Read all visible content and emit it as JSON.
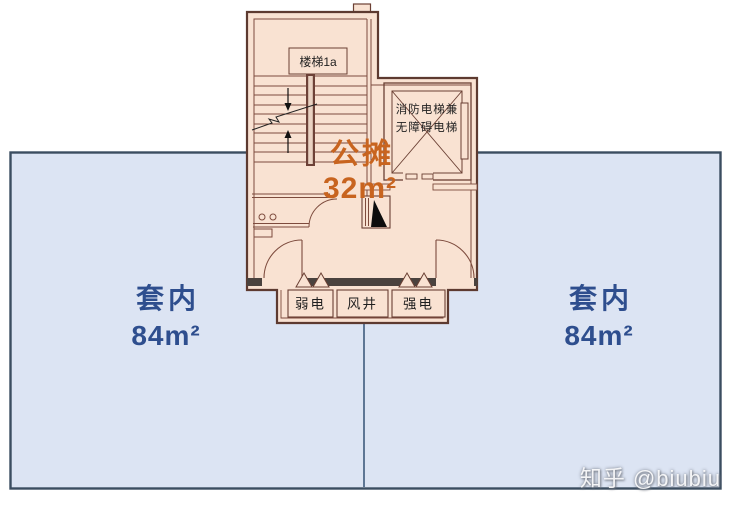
{
  "plan": {
    "stair_label": "楼梯1a",
    "elevator_label_line1": "消防电梯兼",
    "elevator_label_line2": "无障碍电梯",
    "shared": {
      "label": "公摊",
      "area": "32m²"
    },
    "unit_left": {
      "label": "套内",
      "area": "84m²"
    },
    "unit_right": {
      "label": "套内",
      "area": "84m²"
    },
    "service_rooms": [
      {
        "label": "弱电"
      },
      {
        "label": "风井"
      },
      {
        "label": "强电"
      }
    ]
  },
  "watermark": "知乎 @biubiu",
  "colors": {
    "unit_fill": "#dce4f3",
    "unit_border": "#3b4d60",
    "divider_line": "#3f5b7d",
    "plan_fill": "#f9e2d2",
    "wall_line": "#6b4034",
    "wall_poche": "#4a423e",
    "shared_text": "#c8641f",
    "unit_text": "#2e4e8e",
    "watermark_text": "#c9ccd2"
  }
}
